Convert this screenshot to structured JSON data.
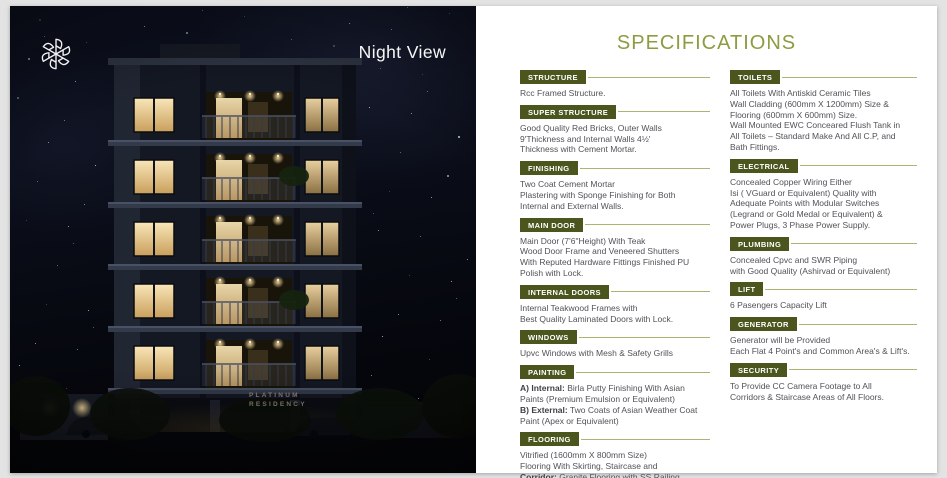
{
  "photo": {
    "caption": "Night View",
    "building_sign_line1": "PLATINUM",
    "building_sign_line2": "RESIDENCY"
  },
  "specifications": {
    "title": "SPECIFICATIONS",
    "columns": [
      {
        "sections": [
          {
            "title": "STRUCTURE",
            "lines": [
              {
                "text": "Rcc Framed Structure."
              }
            ]
          },
          {
            "title": "SUPER STRUCTURE",
            "lines": [
              {
                "text": "Good Quality Red Bricks, Outer Walls"
              },
              {
                "text": "9'Thickness and Internal Walls 4½'"
              },
              {
                "text": "Thickness with Cement Mortar."
              }
            ]
          },
          {
            "title": "FINISHING",
            "lines": [
              {
                "text": "Two Coat Cement Mortar"
              },
              {
                "text": "Plastering with Sponge Finishing for Both"
              },
              {
                "text": "Internal and External Walls."
              }
            ]
          },
          {
            "title": "MAIN DOOR",
            "lines": [
              {
                "text": "Main Door (7'6\"Height) With Teak"
              },
              {
                "text": "Wood Door Frame and Veneered Shutters"
              },
              {
                "text": "With Reputed Hardware Fittings Finished PU"
              },
              {
                "text": "Polish with Lock."
              }
            ]
          },
          {
            "title": "INTERNAL DOORS",
            "lines": [
              {
                "text": "Internal Teakwood Frames with"
              },
              {
                "text": "Best Quality Laminated Doors with Lock."
              }
            ]
          },
          {
            "title": "WINDOWS",
            "lines": [
              {
                "text": "Upvc Windows with Mesh & Safety Grills"
              }
            ]
          },
          {
            "title": "PAINTING",
            "lines": [
              {
                "bold": "A) Internal:",
                "text": " Birla Putty Finishing With Asian"
              },
              {
                "text": "Paints (Premium Emulsion or Equivalent)"
              },
              {
                "bold": "B) External:",
                "text": " Two Coats of Asian Weather Coat"
              },
              {
                "text": "Paint  (Apex or Equivalent)"
              }
            ]
          },
          {
            "title": "FLOORING",
            "lines": [
              {
                "text": "Vitrified (1600mm X 800mm Size)"
              },
              {
                "text": "Flooring With Skirting, Staircase and"
              },
              {
                "bold": "Corridor:",
                "text": " Granite Flooring with SS Railing"
              }
            ]
          }
        ]
      },
      {
        "sections": [
          {
            "title": "TOILETS",
            "lines": [
              {
                "text": "All Toilets With Antiskid Ceramic Tiles"
              },
              {
                "text": "Wall Cladding  (600mm X 1200mm) Size &"
              },
              {
                "text": "Flooring (600mm X 600mm) Size."
              },
              {
                "text": "Wall Mounted EWC Conceared Flush Tank in"
              },
              {
                "text": "All Toilets – Standard Make And All C.P,  and"
              },
              {
                "text": "Bath Fittings."
              }
            ]
          },
          {
            "title": "ELECTRICAL",
            "lines": [
              {
                "text": "Concealed Copper Wiring Either"
              },
              {
                "text": "Isi ( VGuard or Equivalent) Quality with"
              },
              {
                "text": "Adequate Points with Modular Switches"
              },
              {
                "text": "(Legrand or Gold Medal or Equivalent) &"
              },
              {
                "text": "Power Plugs, 3 Phase Power Supply."
              }
            ]
          },
          {
            "title": "PLUMBING",
            "lines": [
              {
                "text": "Concealed Cpvc and SWR Piping"
              },
              {
                "text": "with Good Quality (Ashirvad or Equivalent)"
              }
            ]
          },
          {
            "title": "LIFT",
            "lines": [
              {
                "text": "6 Pasengers Capacity Lift"
              }
            ]
          },
          {
            "title": "GENERATOR",
            "lines": [
              {
                "text": "Generator will be Provided"
              },
              {
                "text": "Each Flat 4 Point's and Common Area's & Lift's."
              }
            ]
          },
          {
            "title": "SECURITY",
            "lines": [
              {
                "text": "To Provide CC Camera Footage to All"
              },
              {
                "text": "Corridors & Staircase Areas of All Floors."
              }
            ]
          }
        ]
      }
    ]
  },
  "colors": {
    "accent_badge": "#4a561e",
    "accent_rule": "#8d9c41",
    "title_green": "#8d9c41",
    "body_text": "#515257",
    "night_sky": "#0a0e19",
    "window_glow": "#f4d9a2",
    "page_background": "#e3e3e4"
  },
  "icons": {
    "brand_logo": "rosette-monogram"
  }
}
